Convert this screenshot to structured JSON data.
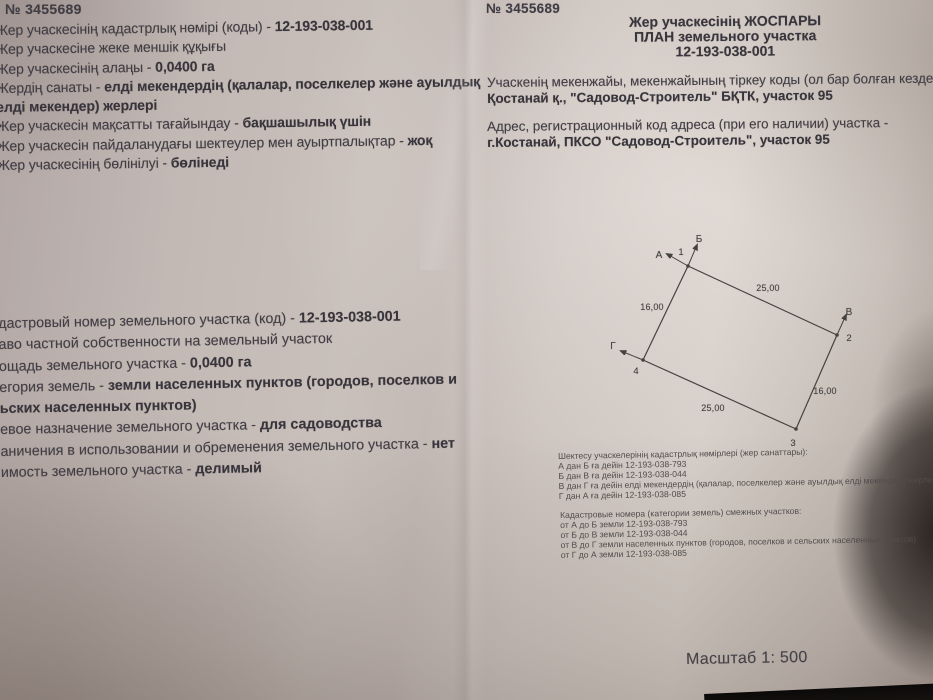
{
  "left_page": {
    "doc_number": "№ 3455689",
    "info_kk": [
      {
        "label": "Жер учаскесінің кадастрлық нөмірі (коды) - ",
        "value": "12-193-038-001"
      },
      {
        "label": "Жер учаскесіне жеке меншік құқығы",
        "value": ""
      },
      {
        "label": "Жер учаскесінің алаңы - ",
        "value": "0,0400 га"
      },
      {
        "label": "Жердің санаты - ",
        "value": "елді мекендердің (қалалар, поселкелер және ауылдық"
      },
      {
        "label": "",
        "value": "елді мекендер) жерлері"
      },
      {
        "label": "Жер учаскесін мақсатты тағайындау - ",
        "value": "бақшашылық үшін"
      },
      {
        "label": "Жер учаскесін пайдаланудағы шектеулер мен ауыртпалықтар - ",
        "value": "жоқ"
      },
      {
        "label": "Жер учаскесінің бөлінілуі - ",
        "value": "бөлінеді"
      }
    ],
    "info_ru": [
      {
        "label": "дастровый номер земельного участка (код) - ",
        "value": "12-193-038-001"
      },
      {
        "label": "аво частной собственности на земельный участок",
        "value": ""
      },
      {
        "label": "ощадь земельного участка - ",
        "value": "0,0400 га"
      },
      {
        "label": "егория земель - ",
        "value": "земли населенных пунктов (городов, поселков и"
      },
      {
        "label": "",
        "value": "ьских населенных пунктов)"
      },
      {
        "label": "евое назначение земельного участка - ",
        "value": "для садоводства"
      },
      {
        "label": "аничения в использовании и обременения земельного участка - ",
        "value": "нет"
      },
      {
        "label": "имость земельного участка - ",
        "value": "делимый"
      }
    ]
  },
  "right_page": {
    "doc_number": "№ 3455689",
    "title_kk": "Жер учаскесінің ЖОСПАРЫ",
    "title_ru": "ПЛАН земельного участка",
    "cadastral_code": "12-193-038-001",
    "address_kk_label": "Учаскенің мекенжайы, мекенжайының тіркеу коды (ол бар болған кезде",
    "address_kk_value": "Қостанай қ., \"Садовод-Строитель\" БҚТК, участок 95",
    "address_ru_label": "Адрес, регистрационный код адреса (при его наличии) участка -",
    "address_ru_value": "г.Костанай, ПКСО  \"Садовод-Строитель\",  участок 95",
    "scale": "Масштаб 1: 500"
  },
  "diagram": {
    "vertices": {
      "v1": "1",
      "v2": "2",
      "v3": "3",
      "v4": "4"
    },
    "directions": {
      "a": "А",
      "b": "Б",
      "v": "В",
      "g": "Г"
    },
    "dimensions": {
      "top": "25,00",
      "left": "16,00",
      "right": "16,00",
      "bottom": "25,00"
    }
  },
  "notes_kk": {
    "header": "Шектесу учаскелерінің кадастрлық нөмірлері (жер санаттары):",
    "lines": [
      "А дан Б ға дейін 12-193-038-793",
      "Б дан В ға дейін 12-193-038-044",
      "В дан Г ға дейін елді мекендердің (қалалар, поселкелер және ауылдық елді мекендер) жерлері",
      "Г дан А ға дейін 12-193-038-085"
    ]
  },
  "notes_ru": {
    "header": "Кадастровые номера (категории земель) смежных участков:",
    "lines": [
      "от А до Б земли 12-193-038-793",
      "от Б до В земли 12-193-038-044",
      "от В до Г земли населенных пунктов (городов, поселков и сельских населенных пунктов)",
      "от Г до А земли 12-193-038-085"
    ]
  }
}
